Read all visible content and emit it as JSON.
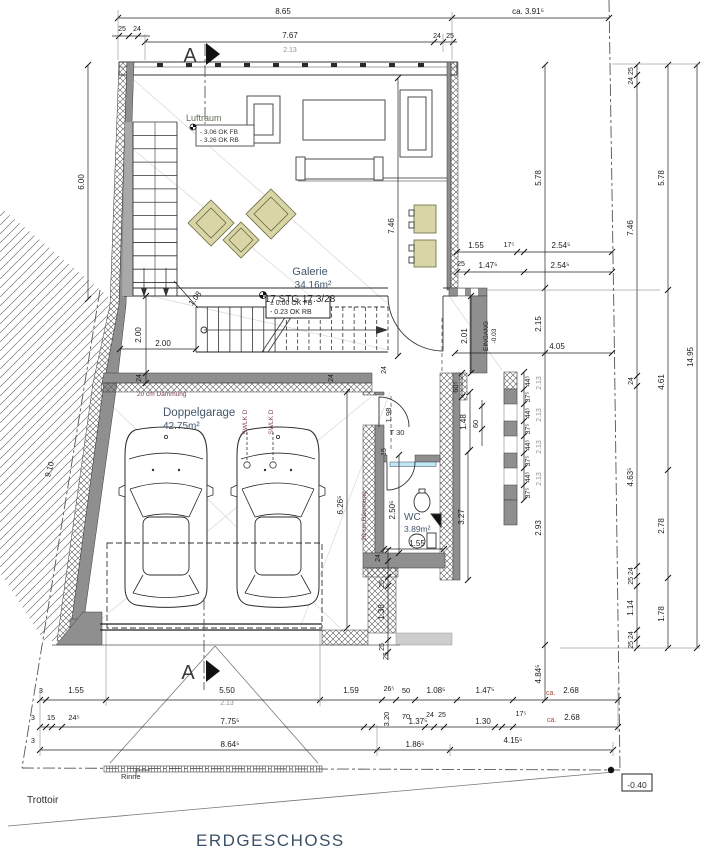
{
  "palette": {
    "wall_gray": "#8f8f8f",
    "furniture_beige": "#d9d5a6",
    "window_glass": "#bfe9f2",
    "title_text": "#3c5166",
    "note_text": "#7d4560",
    "room_text": "#44576b"
  },
  "texts": {
    "title": {
      "t": "ERDGESCHOSS",
      "x": 196,
      "y": 846,
      "s": 17,
      "c": "title",
      "a": "start",
      "n": "drawing-title"
    },
    "section_letters": [
      {
        "t": "A",
        "x": 190,
        "y": 62,
        "s": 20,
        "c": "secA",
        "n": "section-letter-top"
      },
      {
        "t": "A",
        "x": 188,
        "y": 679,
        "s": 20,
        "c": "secA",
        "n": "section-letter-bottom"
      }
    ],
    "site": [
      {
        "t": "Trottoir",
        "x": 27,
        "y": 803,
        "s": 10,
        "c": "black",
        "a": "start",
        "n": "sidewalk-label"
      },
      {
        "t": "Rinne",
        "x": 121,
        "y": 779,
        "s": 7.5,
        "c": "black",
        "a": "start",
        "n": "gutter-label"
      },
      {
        "t": "-0.40",
        "x": 637,
        "y": 788,
        "s": 8.5,
        "c": "black",
        "n": "level-badge-value"
      }
    ],
    "rooms": [
      {
        "t": "Galerie",
        "x": 310,
        "y": 275,
        "s": 11,
        "c": "room",
        "n": "room-label-galerie"
      },
      {
        "t": "34.16m²",
        "x": 313,
        "y": 288,
        "s": 10,
        "c": "room",
        "n": "room-area-galerie"
      },
      {
        "t": "Doppelgarage",
        "x": 163,
        "y": 416,
        "s": 11.5,
        "c": "room",
        "a": "start",
        "n": "room-label-garage"
      },
      {
        "t": "42.75m²",
        "x": 163,
        "y": 429,
        "s": 10,
        "c": "room",
        "a": "start",
        "n": "room-area-garage"
      },
      {
        "t": "WC",
        "x": 404,
        "y": 520,
        "s": 10,
        "c": "room",
        "a": "start",
        "n": "room-label-wc"
      },
      {
        "t": "3.89m²",
        "x": 404,
        "y": 532,
        "s": 8.5,
        "c": "room",
        "a": "start",
        "n": "room-area-wc"
      },
      {
        "t": "Luftraum",
        "x": 186,
        "y": 121,
        "s": 9,
        "c": "olive",
        "a": "start",
        "n": "room-label-luftraum"
      }
    ],
    "levels": [
      {
        "t": "± 0.00 OK FB",
        "x": 270,
        "y": 305,
        "s": 7,
        "c": "black",
        "a": "start",
        "n": "level-text"
      },
      {
        "t": "- 0.23 OK RB",
        "x": 270,
        "y": 314,
        "s": 7,
        "c": "black",
        "a": "start",
        "n": "level-text"
      },
      {
        "t": "- 3.06 OK FB",
        "x": 200,
        "y": 134,
        "s": 6.5,
        "c": "black",
        "a": "start",
        "n": "level-text"
      },
      {
        "t": "- 3.26 OK RB",
        "x": 200,
        "y": 142,
        "s": 6.5,
        "c": "black",
        "a": "start",
        "n": "level-text"
      }
    ],
    "stair": [
      {
        "t": "17 STG 17.3/28",
        "x": 300,
        "y": 302,
        "s": 10,
        "c": "black",
        "n": "stair-label"
      }
    ],
    "notes": [
      {
        "t": "20 cm Dämmung",
        "x": 137,
        "y": 396,
        "s": 6.5,
        "c": "note",
        "a": "start",
        "n": "insulation-note"
      },
      {
        "t": "20 cm Dämmung",
        "x": 366,
        "y": 516,
        "s": 6.5,
        "c": "note",
        "r": -90,
        "n": "insulation-note"
      },
      {
        "t": "SWLK D",
        "x": 247,
        "y": 422,
        "s": 6.5,
        "c": "note",
        "r": -90,
        "n": "drain-note"
      },
      {
        "t": "SWLK D",
        "x": 273,
        "y": 422,
        "s": 6.5,
        "c": "note",
        "r": -90,
        "n": "drain-note"
      },
      {
        "t": "EINGANG",
        "x": 488,
        "y": 336,
        "s": 6.5,
        "r": -90,
        "n": "entrance-label"
      },
      {
        "t": "-0.03",
        "x": 496,
        "y": 336,
        "s": 6.5,
        "r": -90,
        "n": "entrance-level"
      },
      {
        "t": "T 30",
        "x": 397,
        "y": 435,
        "s": 7.5,
        "c": "black",
        "n": "door-label"
      }
    ],
    "dims": [
      {
        "t": "8.65",
        "x": 283,
        "y": 14
      },
      {
        "t": "ca. 3.91⁵",
        "x": 528,
        "y": 14
      },
      {
        "t": "25",
        "x": 122,
        "y": 31,
        "s": 7
      },
      {
        "t": "24",
        "x": 137,
        "y": 31,
        "s": 7
      },
      {
        "t": "7.67",
        "x": 290,
        "y": 38
      },
      {
        "t": "2.13",
        "x": 290,
        "y": 52,
        "s": 7,
        "c": "gray"
      },
      {
        "t": "24",
        "x": 437,
        "y": 38,
        "s": 7
      },
      {
        "t": "25",
        "x": 450,
        "y": 38,
        "s": 7
      },
      {
        "t": "6.00",
        "x": 84,
        "y": 182,
        "r": -90
      },
      {
        "t": "9.10",
        "x": 52,
        "y": 470,
        "r": -75
      },
      {
        "t": "2.00",
        "x": 141,
        "y": 335,
        "r": -90
      },
      {
        "t": "2.00",
        "x": 163,
        "y": 346
      },
      {
        "t": "24",
        "x": 141,
        "y": 378,
        "r": -90,
        "s": 7
      },
      {
        "t": "1.08",
        "x": 197,
        "y": 300,
        "r": -52
      },
      {
        "t": "24",
        "x": 333,
        "y": 378,
        "r": -90,
        "s": 7
      },
      {
        "t": "24",
        "x": 386,
        "y": 370,
        "r": -90,
        "s": 7
      },
      {
        "t": "1.98",
        "x": 391,
        "y": 415,
        "r": -90,
        "s": 7.5
      },
      {
        "t": "15",
        "x": 386,
        "y": 452,
        "r": -90,
        "s": 7
      },
      {
        "t": "2.50⁵",
        "x": 395,
        "y": 510,
        "r": -90
      },
      {
        "t": "1.55",
        "x": 417,
        "y": 546
      },
      {
        "t": "24",
        "x": 380,
        "y": 558,
        "r": -90,
        "s": 7
      },
      {
        "t": "2.01",
        "x": 467,
        "y": 336,
        "r": -90
      },
      {
        "t": "2.13",
        "x": 478,
        "y": 336,
        "r": -90,
        "s": 7,
        "c": "gray"
      },
      {
        "t": "2.15",
        "x": 541,
        "y": 324,
        "r": -90
      },
      {
        "t": "4.05",
        "x": 557,
        "y": 349
      },
      {
        "t": "5.78",
        "x": 541,
        "y": 178,
        "r": -90
      },
      {
        "t": "2.93",
        "x": 541,
        "y": 528,
        "r": -90
      },
      {
        "t": "4.84⁵",
        "x": 541,
        "y": 674,
        "r": -90
      },
      {
        "t": "7.46",
        "x": 394,
        "y": 226,
        "r": -90
      },
      {
        "t": "1.55",
        "x": 476,
        "y": 248
      },
      {
        "t": "17⁵",
        "x": 509,
        "y": 247,
        "s": 7
      },
      {
        "t": "2.54⁵",
        "x": 561,
        "y": 248
      },
      {
        "t": "25",
        "x": 461,
        "y": 266,
        "s": 7
      },
      {
        "t": "1.47⁵",
        "x": 488,
        "y": 268
      },
      {
        "t": "2.54⁵",
        "x": 560,
        "y": 268
      },
      {
        "t": "60⁵",
        "x": 458,
        "y": 387,
        "r": -90,
        "s": 7.5
      },
      {
        "t": "1.48",
        "x": 466,
        "y": 422,
        "r": -90
      },
      {
        "t": "60",
        "x": 478,
        "y": 424,
        "r": -90,
        "s": 7.5
      },
      {
        "t": "3.27",
        "x": 464,
        "y": 517,
        "r": -90
      },
      {
        "t": "6.26⁵",
        "x": 343,
        "y": 505,
        "r": -90
      },
      {
        "t": "44⁵",
        "x": 530,
        "y": 381,
        "r": -90,
        "s": 7
      },
      {
        "t": "37⁵",
        "x": 530,
        "y": 397,
        "r": -90,
        "s": 7
      },
      {
        "t": "44⁵",
        "x": 530,
        "y": 413,
        "r": -90,
        "s": 7
      },
      {
        "t": "37⁵",
        "x": 530,
        "y": 429,
        "r": -90,
        "s": 7
      },
      {
        "t": "44⁵",
        "x": 530,
        "y": 445,
        "r": -90,
        "s": 7
      },
      {
        "t": "37⁵",
        "x": 530,
        "y": 461,
        "r": -90,
        "s": 7
      },
      {
        "t": "44⁵",
        "x": 530,
        "y": 477,
        "r": -90,
        "s": 7
      },
      {
        "t": "37⁵",
        "x": 530,
        "y": 493,
        "r": -90,
        "s": 7
      },
      {
        "t": "2.13",
        "x": 541,
        "y": 383,
        "r": -90,
        "s": 7,
        "c": "gray"
      },
      {
        "t": "2.13",
        "x": 541,
        "y": 415,
        "r": -90,
        "s": 7,
        "c": "gray"
      },
      {
        "t": "2.13",
        "x": 541,
        "y": 447,
        "r": -90,
        "s": 7,
        "c": "gray"
      },
      {
        "t": "2.13",
        "x": 541,
        "y": 479,
        "r": -90,
        "s": 7,
        "c": "gray"
      },
      {
        "t": "24 25",
        "x": 633,
        "y": 76,
        "r": -90,
        "s": 7
      },
      {
        "t": "7.46",
        "x": 633,
        "y": 228,
        "r": -90
      },
      {
        "t": "24",
        "x": 633,
        "y": 381,
        "r": -90,
        "s": 7
      },
      {
        "t": "4.63⁵",
        "x": 633,
        "y": 477,
        "r": -90
      },
      {
        "t": "25 24",
        "x": 633,
        "y": 576,
        "r": -90,
        "s": 7
      },
      {
        "t": "1.14",
        "x": 633,
        "y": 608,
        "r": -90
      },
      {
        "t": "25 24",
        "x": 633,
        "y": 640,
        "r": -90,
        "s": 7
      },
      {
        "t": "5.78",
        "x": 664,
        "y": 178,
        "r": -90
      },
      {
        "t": "4.61",
        "x": 664,
        "y": 382,
        "r": -90
      },
      {
        "t": "2.78",
        "x": 664,
        "y": 526,
        "r": -90
      },
      {
        "t": "1.78",
        "x": 664,
        "y": 614,
        "r": -90
      },
      {
        "t": "14.95",
        "x": 693,
        "y": 357,
        "r": -90
      },
      {
        "t": "25",
        "x": 384,
        "y": 584,
        "r": -90,
        "s": 7
      },
      {
        "t": "1.38",
        "x": 384,
        "y": 612,
        "r": -90
      },
      {
        "t": "25",
        "x": 384,
        "y": 647,
        "r": -90,
        "s": 7
      },
      {
        "t": "25",
        "x": 388,
        "y": 656,
        "r": -90,
        "s": 7
      },
      {
        "t": "3",
        "x": 41,
        "y": 693,
        "s": 7
      },
      {
        "t": "1.55",
        "x": 76,
        "y": 693
      },
      {
        "t": "5.50",
        "x": 227,
        "y": 693
      },
      {
        "t": "2.13",
        "x": 227,
        "y": 705,
        "s": 7,
        "c": "gray"
      },
      {
        "t": "1.59",
        "x": 351,
        "y": 693
      },
      {
        "t": "26⁵",
        "x": 389,
        "y": 691,
        "s": 7
      },
      {
        "t": "50",
        "x": 406,
        "y": 693,
        "s": 7.5
      },
      {
        "t": "1.08⁵",
        "x": 436,
        "y": 693
      },
      {
        "t": "1.47⁵",
        "x": 485,
        "y": 693
      },
      {
        "t": "ca.",
        "x": 546,
        "y": 695,
        "s": 7,
        "c": "red",
        "a": "start"
      },
      {
        "t": "2.68",
        "x": 571,
        "y": 693
      },
      {
        "t": "3",
        "x": 33,
        "y": 720,
        "s": 7
      },
      {
        "t": "15",
        "x": 51,
        "y": 720,
        "s": 7.5
      },
      {
        "t": "24⁵",
        "x": 74,
        "y": 720,
        "s": 7.5
      },
      {
        "t": "7.75⁵",
        "x": 230,
        "y": 724
      },
      {
        "t": "3.20",
        "x": 389,
        "y": 719,
        "r": -90,
        "s": 7.5
      },
      {
        "t": "70",
        "x": 406,
        "y": 719,
        "s": 7.5
      },
      {
        "t": "1.37⁵",
        "x": 418,
        "y": 724
      },
      {
        "t": "24",
        "x": 430,
        "y": 717,
        "s": 7
      },
      {
        "t": "25",
        "x": 442,
        "y": 717,
        "s": 7
      },
      {
        "t": "1.30",
        "x": 483,
        "y": 724
      },
      {
        "t": "17⁵",
        "x": 521,
        "y": 716,
        "s": 7
      },
      {
        "t": "ca.",
        "x": 547,
        "y": 722,
        "s": 7,
        "c": "red",
        "a": "start"
      },
      {
        "t": "2.68",
        "x": 572,
        "y": 720
      },
      {
        "t": "3",
        "x": 33,
        "y": 743,
        "s": 7
      },
      {
        "t": "8.64⁵",
        "x": 230,
        "y": 747
      },
      {
        "t": "1.86⁵",
        "x": 415,
        "y": 747
      },
      {
        "t": "4.15⁵",
        "x": 513,
        "y": 743
      }
    ]
  }
}
